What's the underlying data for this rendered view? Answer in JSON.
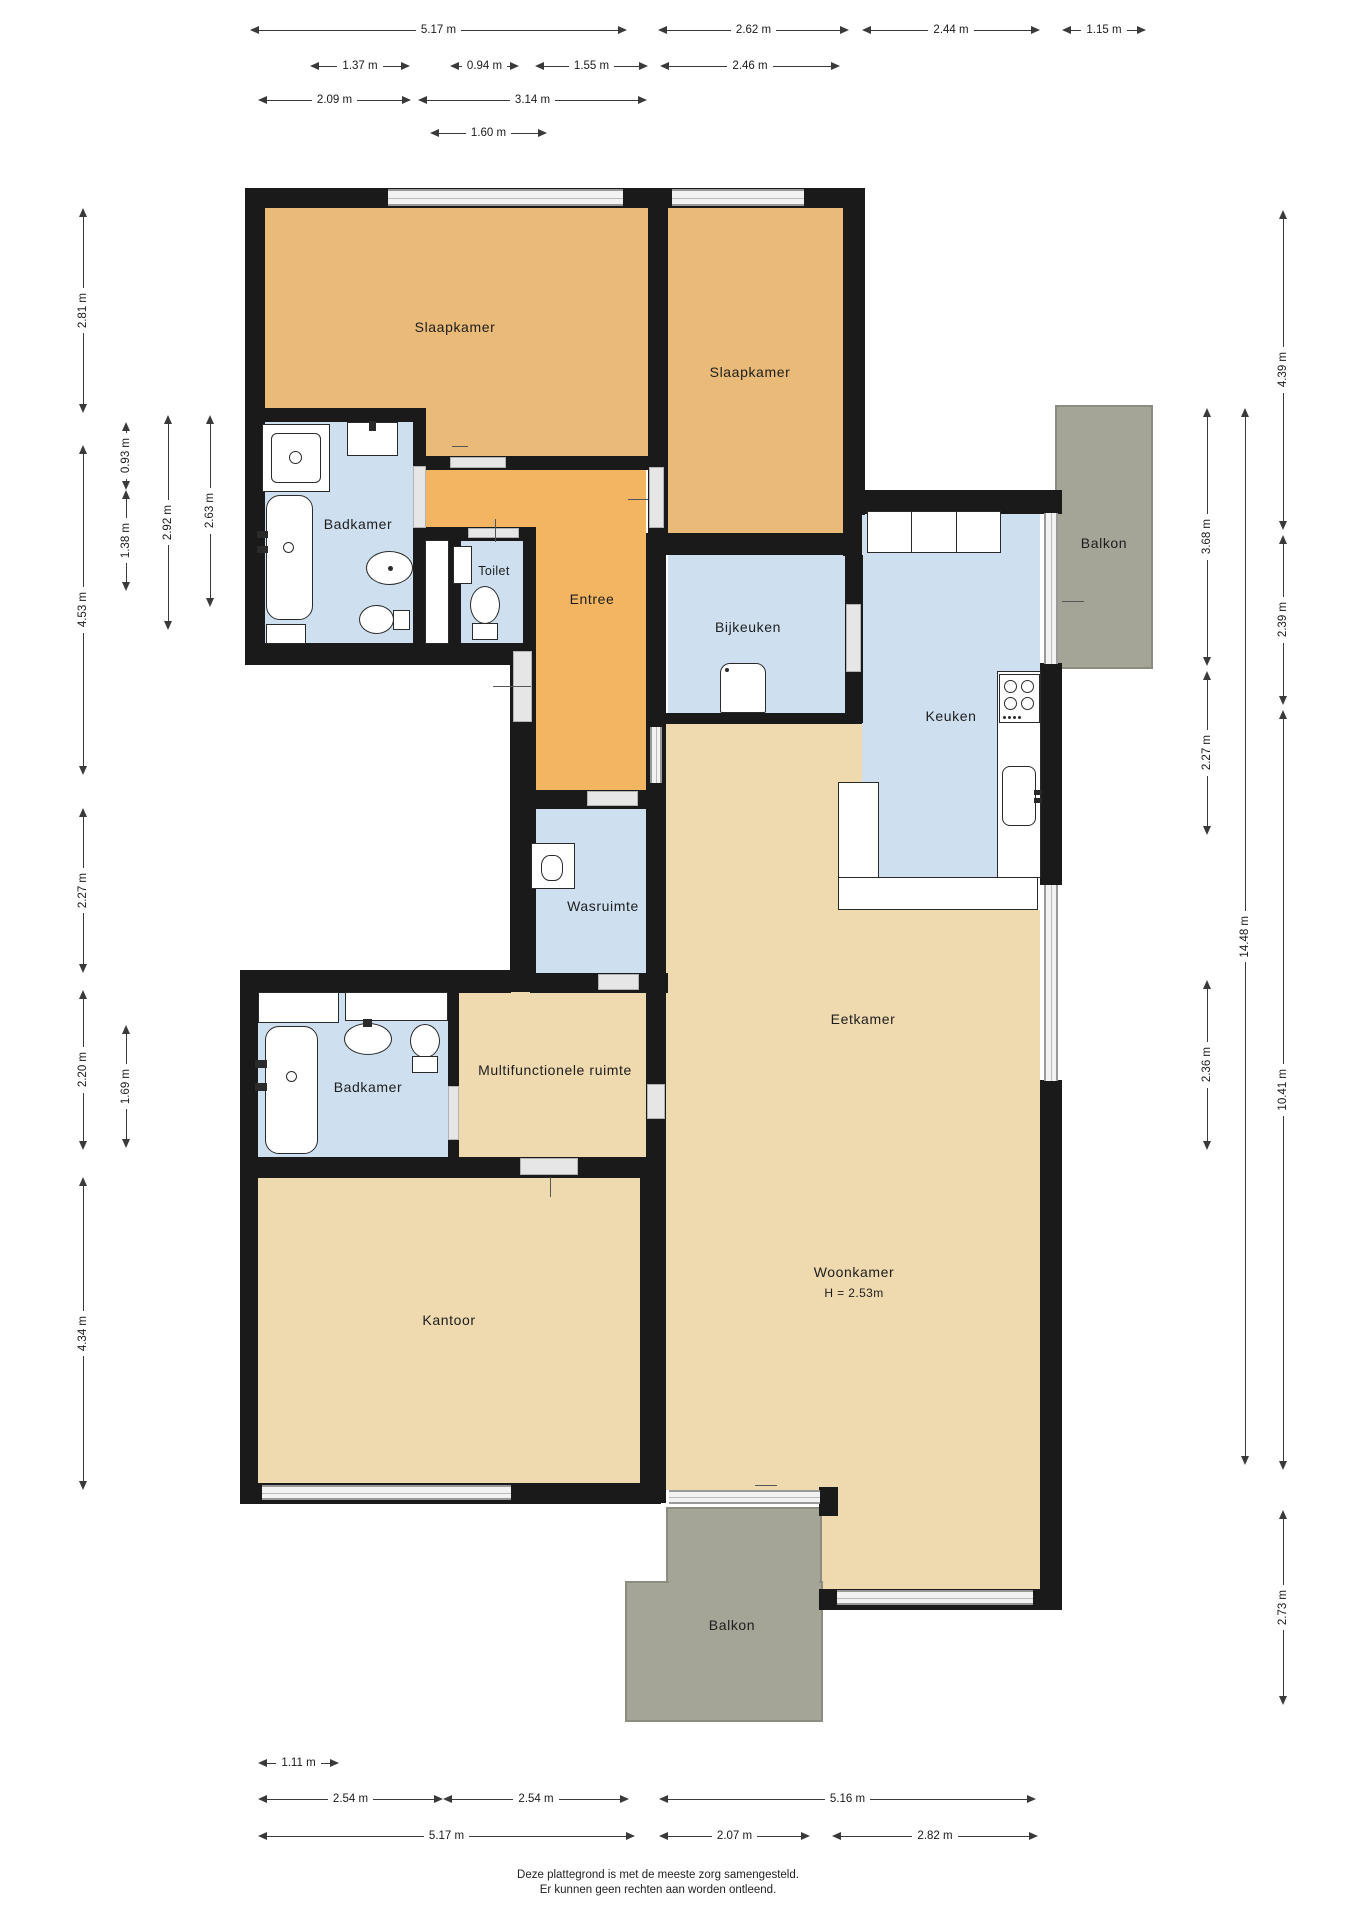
{
  "rooms": {
    "slaapkamer_1": "Slaapkamer",
    "slaapkamer_2": "Slaapkamer",
    "badkamer_1": "Badkamer",
    "toilet": "Toilet",
    "entree": "Entree",
    "bijkeuken": "Bijkeuken",
    "keuken": "Keuken",
    "balkon_1": "Balkon",
    "wasruimte": "Wasruimte",
    "badkamer_2": "Badkamer",
    "multifunctionele_ruimte": "Multifunctionele ruimte",
    "kantoor": "Kantoor",
    "eetkamer": "Eetkamer",
    "woonkamer": "Woonkamer",
    "woonkamer_hoogte": "H = 2.53m",
    "balkon_2": "Balkon"
  },
  "dimensions": {
    "top": [
      "5.17 m",
      "2.62 m",
      "2.44 m",
      "1.15 m",
      "1.37 m",
      "0.94 m",
      "1.55 m",
      "2.46 m",
      "2.09 m",
      "3.14 m",
      "1.60 m"
    ],
    "bottom": [
      "1.11 m",
      "2.54 m",
      "2.54 m",
      "5.16 m",
      "5.17 m",
      "2.07 m",
      "2.82 m"
    ],
    "left": [
      "2.81 m",
      "0.93 m",
      "2.92 m",
      "2.63 m",
      "1.38 m",
      "4.53 m",
      "2.27 m",
      "2.20 m",
      "1.69 m",
      "4.34 m"
    ],
    "right": [
      "4.39 m",
      "3.68 m",
      "2.39 m",
      "2.27 m",
      "2.36 m",
      "14.48 m",
      "10.41 m",
      "2.73 m"
    ]
  },
  "footer": {
    "line1": "Deze plattegrond is met de meeste zorg samengesteld.",
    "line2": "Er kunnen geen rechten aan worden ontleend."
  },
  "palette": {
    "bedroom_fill": "#EABA78",
    "hallway_fill": "#F3B561",
    "living_fill": "#EFD9AF",
    "wet_room_fill": "#CEE0F0",
    "balcony_fill": "#A4A497",
    "wall": "#1A1A1A",
    "window": "#F2F2F2",
    "dimension_line": "#3A3A3A"
  }
}
